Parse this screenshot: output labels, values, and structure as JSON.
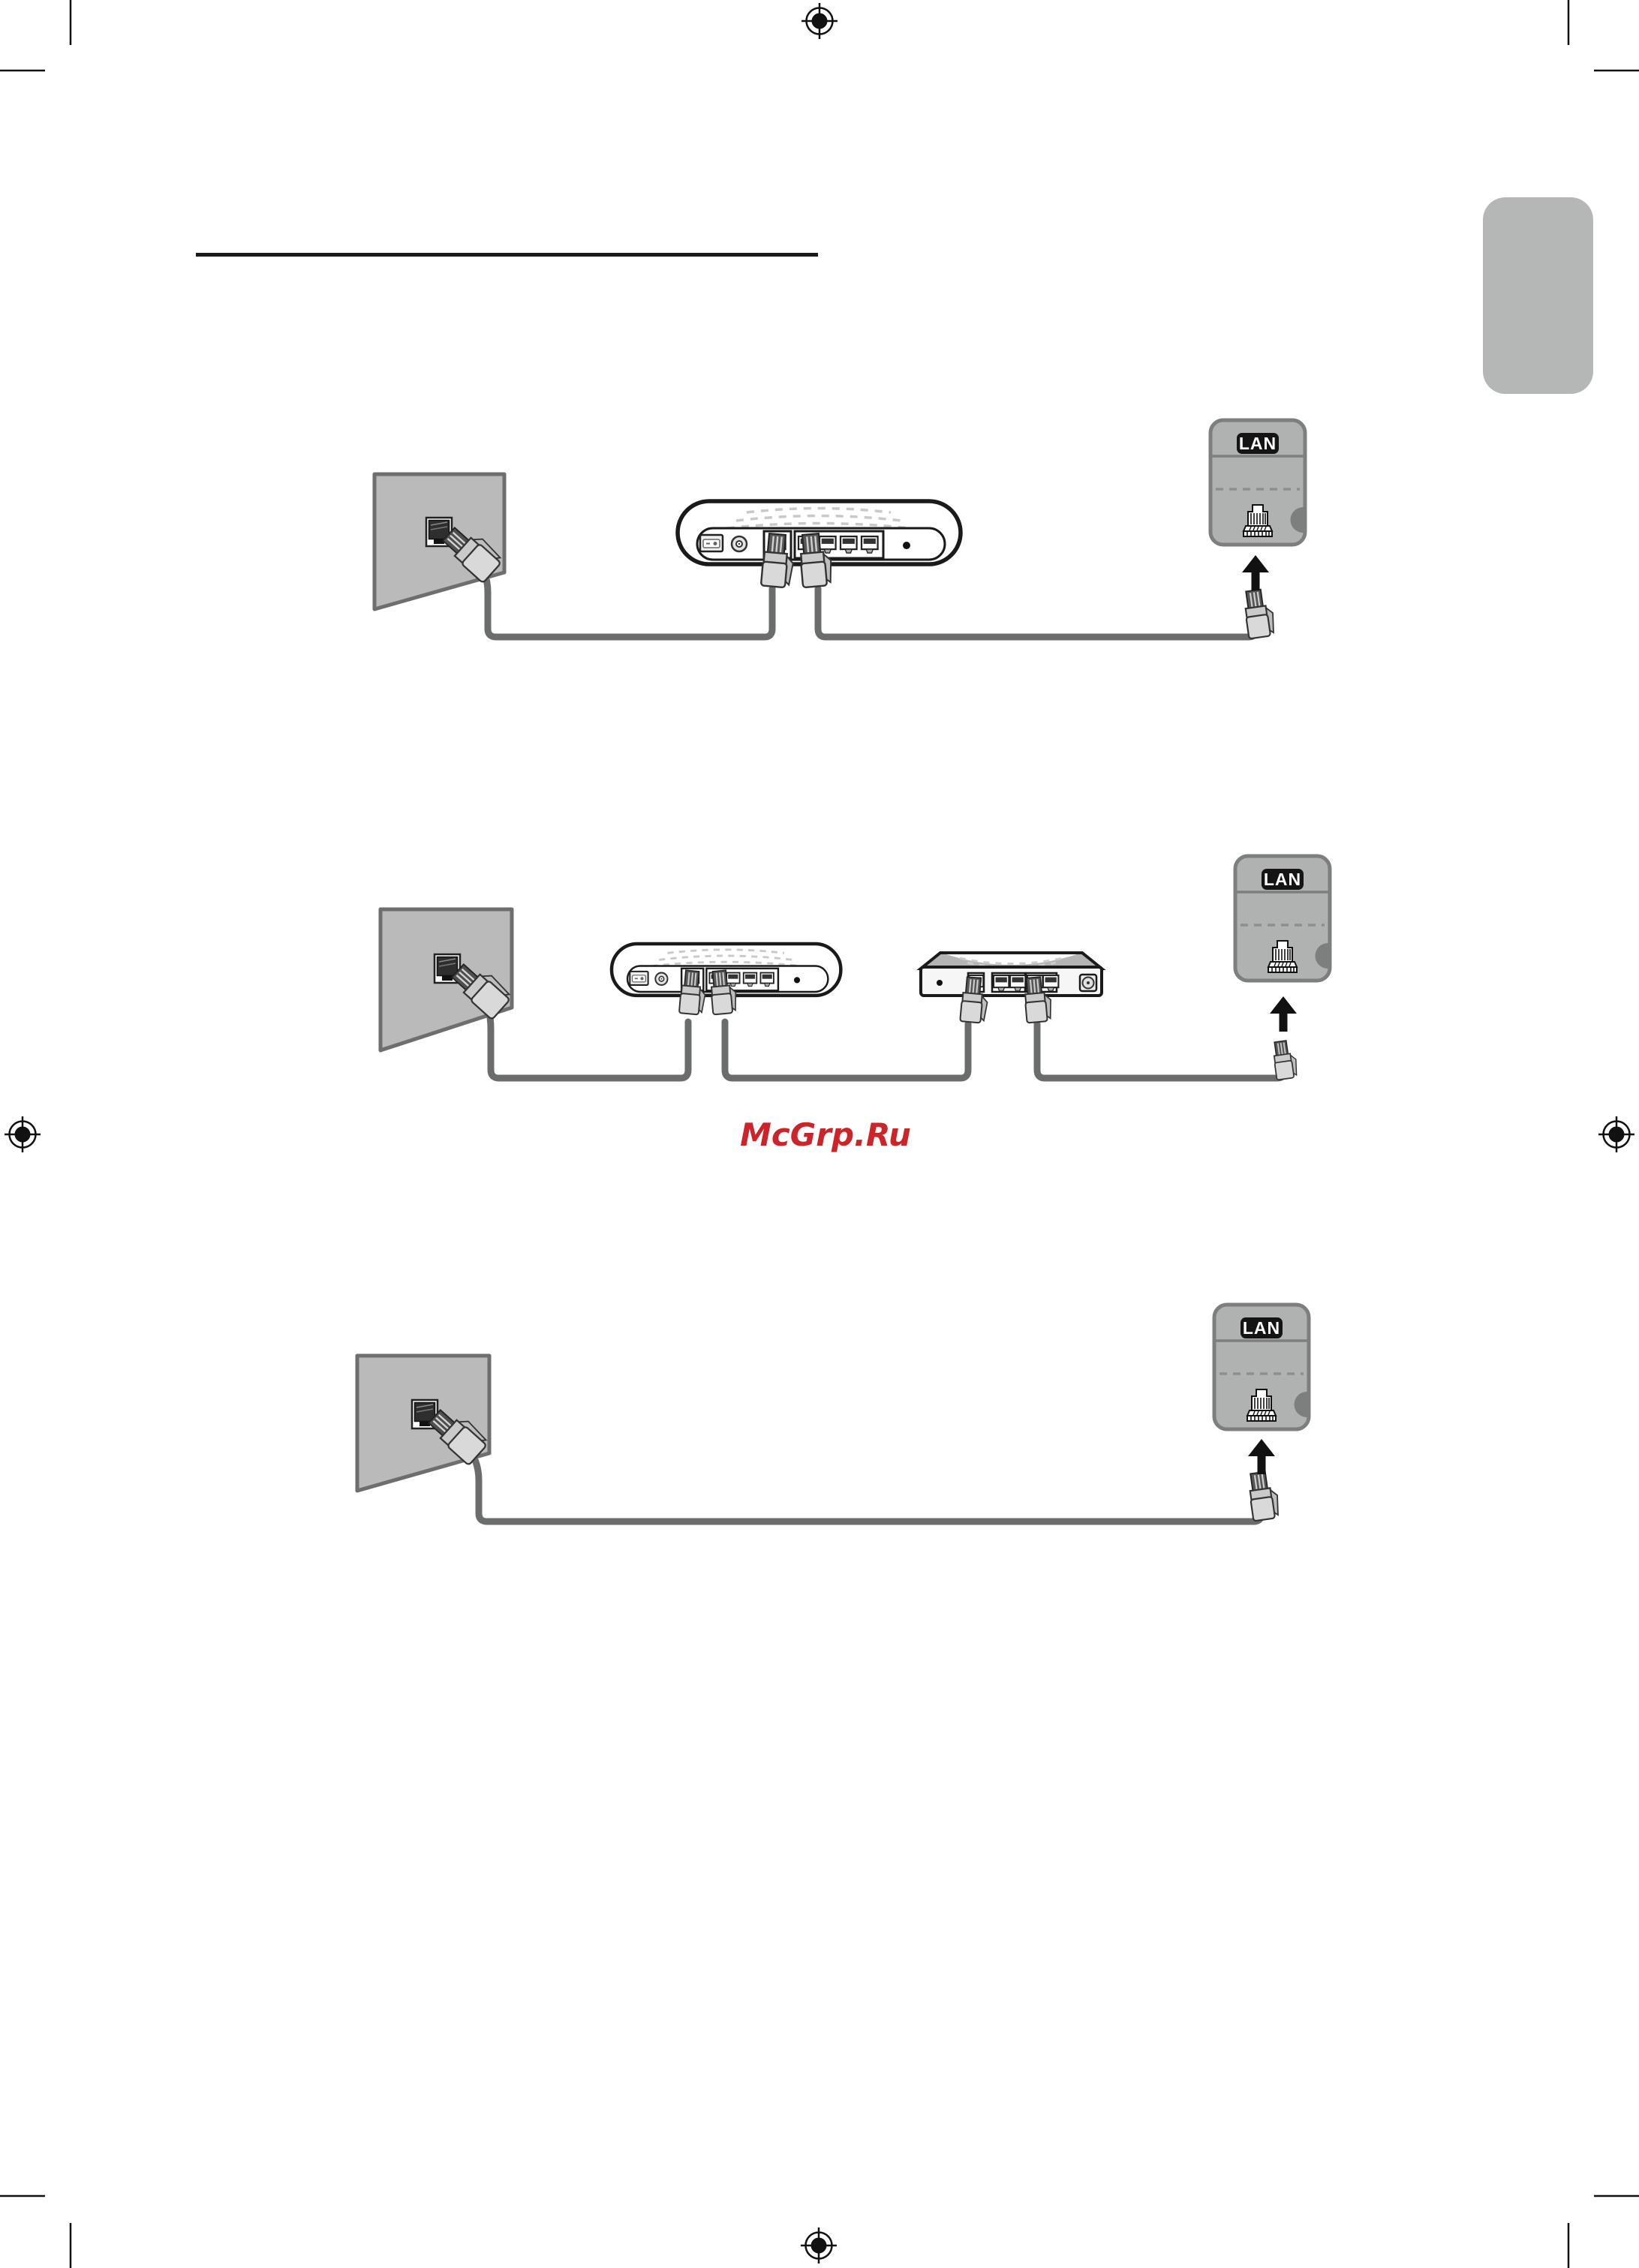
{
  "page": {
    "kind": "printed-manual-page-network-connection-diagrams",
    "background": "#ffffff",
    "watermark": {
      "text": "McGrp.Ru",
      "color": "#cc2428"
    }
  },
  "colors": {
    "ink": "#111111",
    "wall_fill": "#b9bab9",
    "wall_stroke": "#6e6e6e",
    "cable": "#6b6d6c",
    "lan_box_fill": "#b0b2b1",
    "lan_box_stroke": "#7d7f7e",
    "lan_label_bg": "#141414",
    "lan_label_text": "#ffffff",
    "side_tab": "#b5b7b6",
    "plug_fill": "#d8d9d8",
    "watermark_red": "#cc2428"
  },
  "icons": {
    "registration_mark": "printer-registration-crosshair",
    "crop_mark": "corner-crop-line",
    "wall_outlet": "ethernet-wall-outlet",
    "modem": "external-modem-rear-panel",
    "router": "ip-router-rear-panel",
    "tv_lan_port": "tv-lan-port-panel",
    "plug": "rj45-connector",
    "cable": "ethernet-cable",
    "arrow": "arrow-up"
  },
  "diagrams": [
    {
      "name": "wired-connection-via-external-modem",
      "lan_label": "LAN",
      "components": [
        "wall-lan-outlet",
        "external-modem",
        "tv-lan-port"
      ]
    },
    {
      "name": "wired-connection-via-modem-and-ip-router",
      "lan_label": "LAN",
      "components": [
        "wall-lan-outlet",
        "external-modem",
        "ip-router",
        "tv-lan-port"
      ]
    },
    {
      "name": "wired-connection-direct-wall-to-tv",
      "lan_label": "LAN",
      "components": [
        "wall-lan-outlet",
        "tv-lan-port"
      ]
    }
  ]
}
